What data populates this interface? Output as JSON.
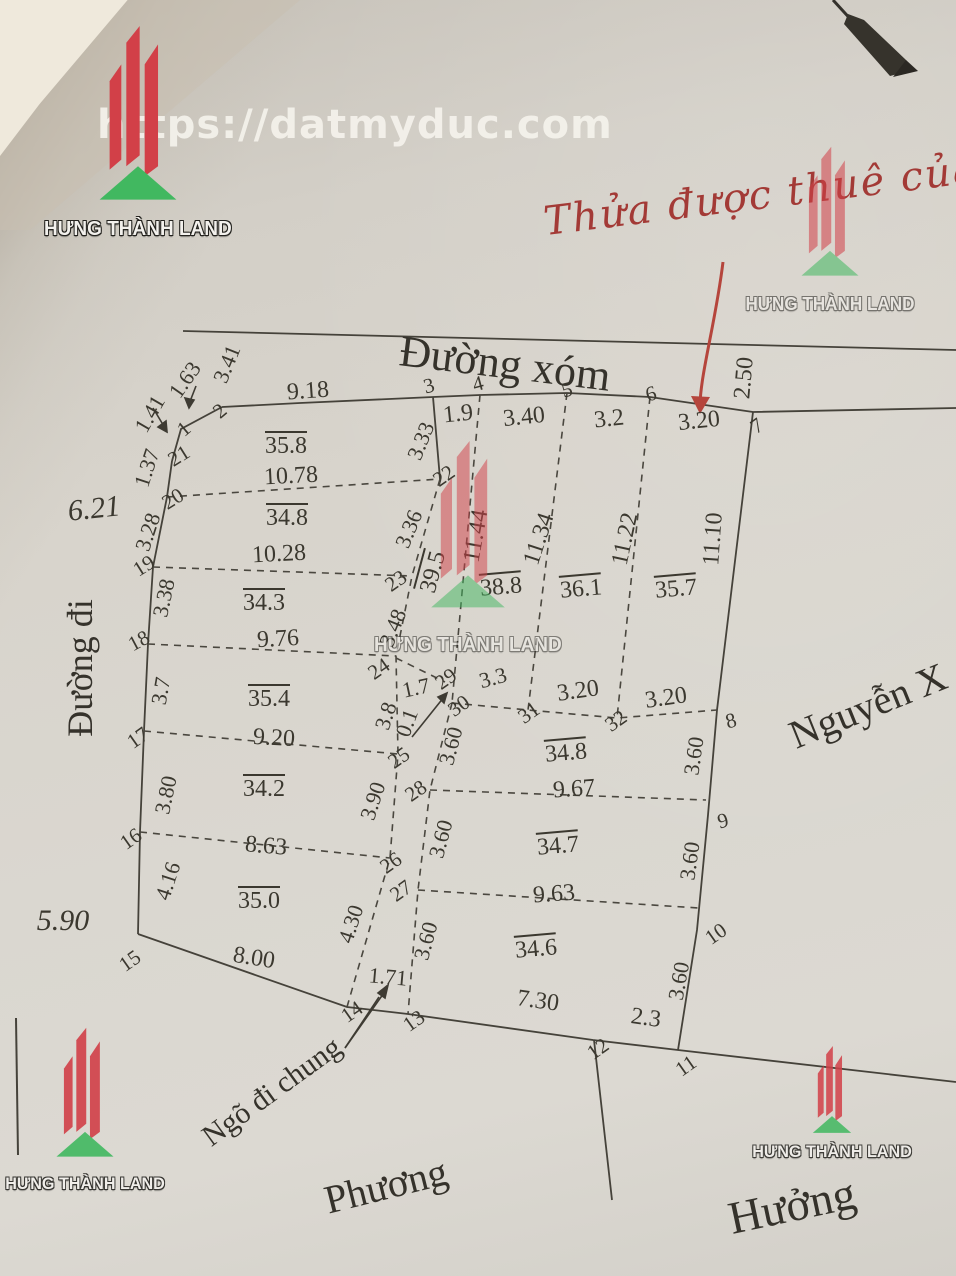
{
  "watermark": {
    "url_text": "https://datmyduc.com",
    "brand": "HƯNG THÀNH LAND",
    "brand_red": "#d24048",
    "brand_green": "#41b860"
  },
  "annotation": {
    "handwriting": "Thửa được thuê của đ",
    "color": "#a33a36"
  },
  "streets": {
    "top_road": "Đường xóm",
    "left_road": "Đường đi",
    "right_owner": "Nguyễn X",
    "bottom_left_owner": "Phương",
    "bottom_right_owner": "Hưởng",
    "alley": "Ngõ đi chung"
  },
  "map": {
    "labels": [
      {
        "t": "Đường xóm",
        "x": 505,
        "y": 364,
        "r": 7,
        "s": 44,
        "c": "street",
        "n": "street-duong-xom"
      },
      {
        "t": "Đường đi",
        "x": 80,
        "y": 668,
        "r": -90,
        "s": 36,
        "c": "street",
        "n": "street-duong-di"
      },
      {
        "t": "Nguyễn X",
        "x": 868,
        "y": 706,
        "r": -22,
        "s": 40,
        "c": "street",
        "n": "owner-nguyen-x"
      },
      {
        "t": "Phương",
        "x": 386,
        "y": 1186,
        "r": -14,
        "s": 40,
        "c": "street",
        "n": "owner-phuong"
      },
      {
        "t": "Hưởng",
        "x": 792,
        "y": 1206,
        "r": -12,
        "s": 46,
        "c": "street",
        "n": "owner-huong"
      },
      {
        "t": "Ngõ đi chung",
        "x": 272,
        "y": 1092,
        "r": -36,
        "s": 30,
        "c": "street",
        "n": "alley-label"
      },
      {
        "t": "Thửa được thuê của đ",
        "x": 782,
        "y": 193,
        "r": -7,
        "s": 40,
        "c": "note",
        "n": "handwritten-note"
      },
      {
        "t": "6.21",
        "x": 94,
        "y": 509,
        "r": -6,
        "s": 30,
        "c": "road-num"
      },
      {
        "t": "5.90",
        "x": 63,
        "y": 921,
        "r": 0,
        "s": 30,
        "c": "road-num"
      },
      {
        "t": "35.8",
        "x": 286,
        "y": 446,
        "r": 0,
        "s": 24,
        "c": "area"
      },
      {
        "t": "34.8",
        "x": 287,
        "y": 518,
        "r": 0,
        "s": 24,
        "c": "area"
      },
      {
        "t": "34.3",
        "x": 264,
        "y": 603,
        "r": 0,
        "s": 24,
        "c": "area"
      },
      {
        "t": "35.4",
        "x": 269,
        "y": 699,
        "r": 0,
        "s": 24,
        "c": "area"
      },
      {
        "t": "34.2",
        "x": 264,
        "y": 789,
        "r": 0,
        "s": 24,
        "c": "area"
      },
      {
        "t": "35.0",
        "x": 259,
        "y": 901,
        "r": 0,
        "s": 24,
        "c": "area"
      },
      {
        "t": "39.5",
        "x": 433,
        "y": 572,
        "r": -75,
        "s": 24,
        "c": "area"
      },
      {
        "t": "38.8",
        "x": 501,
        "y": 587,
        "r": -5,
        "s": 24,
        "c": "area"
      },
      {
        "t": "36.1",
        "x": 581,
        "y": 589,
        "r": -5,
        "s": 24,
        "c": "area"
      },
      {
        "t": "35.7",
        "x": 676,
        "y": 589,
        "r": -5,
        "s": 24,
        "c": "area"
      },
      {
        "t": "34.8",
        "x": 566,
        "y": 753,
        "r": -5,
        "s": 24,
        "c": "area"
      },
      {
        "t": "34.7",
        "x": 558,
        "y": 846,
        "r": -5,
        "s": 24,
        "c": "area"
      },
      {
        "t": "34.6",
        "x": 536,
        "y": 949,
        "r": -5,
        "s": 24,
        "c": "area"
      },
      {
        "t": "10.78",
        "x": 291,
        "y": 476,
        "r": -3,
        "s": 24,
        "c": "dim"
      },
      {
        "t": "10.28",
        "x": 279,
        "y": 554,
        "r": -3,
        "s": 24,
        "c": "dim"
      },
      {
        "t": "9.76",
        "x": 278,
        "y": 639,
        "r": -3,
        "s": 24,
        "c": "dim"
      },
      {
        "t": "9.20",
        "x": 274,
        "y": 738,
        "r": 3,
        "s": 24,
        "c": "dim"
      },
      {
        "t": "8.63",
        "x": 266,
        "y": 846,
        "r": 5,
        "s": 24,
        "c": "dim"
      },
      {
        "t": "8.00",
        "x": 254,
        "y": 958,
        "r": 9,
        "s": 24,
        "c": "dim"
      },
      {
        "t": "9.18",
        "x": 308,
        "y": 391,
        "r": -4,
        "s": 24,
        "c": "dim"
      },
      {
        "t": "1.9",
        "x": 458,
        "y": 414,
        "r": -6,
        "s": 24,
        "c": "dim"
      },
      {
        "t": "3.40",
        "x": 524,
        "y": 417,
        "r": -6,
        "s": 24,
        "c": "dim"
      },
      {
        "t": "3.2",
        "x": 609,
        "y": 419,
        "r": -6,
        "s": 24,
        "c": "dim"
      },
      {
        "t": "3.20",
        "x": 699,
        "y": 421,
        "r": -6,
        "s": 24,
        "c": "dim"
      },
      {
        "t": "9.67",
        "x": 574,
        "y": 789,
        "r": -4,
        "s": 24,
        "c": "dim"
      },
      {
        "t": "9.63",
        "x": 554,
        "y": 894,
        "r": -4,
        "s": 24,
        "c": "dim"
      },
      {
        "t": "7.30",
        "x": 538,
        "y": 1001,
        "r": 8,
        "s": 24,
        "c": "dim"
      },
      {
        "t": "2.3",
        "x": 646,
        "y": 1018,
        "r": 8,
        "s": 24,
        "c": "dim"
      },
      {
        "t": "1.71",
        "x": 388,
        "y": 977,
        "r": 5,
        "s": 22,
        "c": "dim"
      },
      {
        "t": "1.7",
        "x": 416,
        "y": 688,
        "r": -12,
        "s": 22,
        "c": "dim"
      },
      {
        "t": "3.3",
        "x": 493,
        "y": 678,
        "r": -15,
        "s": 22,
        "c": "dim"
      },
      {
        "t": "3.20",
        "x": 578,
        "y": 691,
        "r": -8,
        "s": 24,
        "c": "dim"
      },
      {
        "t": "3.20",
        "x": 666,
        "y": 698,
        "r": -8,
        "s": 24,
        "c": "dim"
      },
      {
        "t": "1.63",
        "x": 185,
        "y": 380,
        "r": -55,
        "s": 22,
        "c": "seg"
      },
      {
        "t": "3.41",
        "x": 227,
        "y": 364,
        "r": -68,
        "s": 22,
        "c": "seg"
      },
      {
        "t": "1.41",
        "x": 150,
        "y": 414,
        "r": -60,
        "s": 22,
        "c": "seg"
      },
      {
        "t": "1.37",
        "x": 147,
        "y": 468,
        "r": -72,
        "s": 22,
        "c": "seg"
      },
      {
        "t": "3.28",
        "x": 148,
        "y": 532,
        "r": -72,
        "s": 22,
        "c": "seg"
      },
      {
        "t": "3.38",
        "x": 164,
        "y": 598,
        "r": -78,
        "s": 22,
        "c": "seg"
      },
      {
        "t": "3.7",
        "x": 161,
        "y": 691,
        "r": -80,
        "s": 22,
        "c": "seg"
      },
      {
        "t": "3.80",
        "x": 166,
        "y": 795,
        "r": -78,
        "s": 22,
        "c": "seg"
      },
      {
        "t": "4.16",
        "x": 168,
        "y": 881,
        "r": -72,
        "s": 22,
        "c": "seg"
      },
      {
        "t": "3.33",
        "x": 421,
        "y": 441,
        "r": -68,
        "s": 22,
        "c": "seg"
      },
      {
        "t": "3.36",
        "x": 409,
        "y": 529,
        "r": -68,
        "s": 22,
        "c": "seg"
      },
      {
        "t": "3.48",
        "x": 393,
        "y": 628,
        "r": -68,
        "s": 22,
        "c": "seg"
      },
      {
        "t": "3.8",
        "x": 386,
        "y": 716,
        "r": -72,
        "s": 22,
        "c": "seg"
      },
      {
        "t": "0.1",
        "x": 407,
        "y": 723,
        "r": -70,
        "s": 22,
        "c": "seg"
      },
      {
        "t": "3.90",
        "x": 373,
        "y": 801,
        "r": -72,
        "s": 22,
        "c": "seg"
      },
      {
        "t": "4.30",
        "x": 351,
        "y": 924,
        "r": -72,
        "s": 22,
        "c": "seg"
      },
      {
        "t": "3.60",
        "x": 451,
        "y": 746,
        "r": -75,
        "s": 22,
        "c": "seg"
      },
      {
        "t": "3.60",
        "x": 441,
        "y": 839,
        "r": -75,
        "s": 22,
        "c": "seg"
      },
      {
        "t": "3.60",
        "x": 426,
        "y": 941,
        "r": -75,
        "s": 22,
        "c": "seg"
      },
      {
        "t": "3.60",
        "x": 694,
        "y": 756,
        "r": -82,
        "s": 22,
        "c": "seg"
      },
      {
        "t": "3.60",
        "x": 690,
        "y": 861,
        "r": -82,
        "s": 22,
        "c": "seg"
      },
      {
        "t": "3.60",
        "x": 679,
        "y": 981,
        "r": -80,
        "s": 22,
        "c": "seg"
      },
      {
        "t": "2.50",
        "x": 744,
        "y": 378,
        "r": -85,
        "s": 24,
        "c": "seg"
      },
      {
        "t": "11.44",
        "x": 476,
        "y": 536,
        "r": -80,
        "s": 24,
        "c": "seg"
      },
      {
        "t": "11.34",
        "x": 539,
        "y": 539,
        "r": -72,
        "s": 24,
        "c": "seg"
      },
      {
        "t": "11.22",
        "x": 625,
        "y": 539,
        "r": -78,
        "s": 24,
        "c": "seg"
      },
      {
        "t": "11.10",
        "x": 713,
        "y": 539,
        "r": -86,
        "s": 24,
        "c": "seg"
      },
      {
        "t": "1",
        "x": 184,
        "y": 429,
        "r": -40,
        "s": 21,
        "c": "vtx"
      },
      {
        "t": "2",
        "x": 220,
        "y": 411,
        "r": -40,
        "s": 21,
        "c": "vtx"
      },
      {
        "t": "3",
        "x": 429,
        "y": 386,
        "r": -15,
        "s": 21,
        "c": "vtx"
      },
      {
        "t": "4",
        "x": 478,
        "y": 384,
        "r": -15,
        "s": 21,
        "c": "vtx"
      },
      {
        "t": "5",
        "x": 567,
        "y": 390,
        "r": -15,
        "s": 21,
        "c": "vtx"
      },
      {
        "t": "6",
        "x": 651,
        "y": 394,
        "r": -15,
        "s": 21,
        "c": "vtx"
      },
      {
        "t": "7",
        "x": 757,
        "y": 426,
        "r": -35,
        "s": 21,
        "c": "vtx"
      },
      {
        "t": "8",
        "x": 731,
        "y": 721,
        "r": -15,
        "s": 21,
        "c": "vtx"
      },
      {
        "t": "9",
        "x": 723,
        "y": 821,
        "r": -15,
        "s": 21,
        "c": "vtx"
      },
      {
        "t": "10",
        "x": 716,
        "y": 934,
        "r": -35,
        "s": 21,
        "c": "vtx"
      },
      {
        "t": "11",
        "x": 686,
        "y": 1066,
        "r": -35,
        "s": 21,
        "c": "vtx"
      },
      {
        "t": "12",
        "x": 598,
        "y": 1049,
        "r": -35,
        "s": 21,
        "c": "vtx"
      },
      {
        "t": "13",
        "x": 414,
        "y": 1021,
        "r": -35,
        "s": 21,
        "c": "vtx"
      },
      {
        "t": "14",
        "x": 352,
        "y": 1012,
        "r": -35,
        "s": 21,
        "c": "vtx"
      },
      {
        "t": "15",
        "x": 130,
        "y": 961,
        "r": -35,
        "s": 21,
        "c": "vtx"
      },
      {
        "t": "16",
        "x": 131,
        "y": 839,
        "r": -35,
        "s": 21,
        "c": "vtx"
      },
      {
        "t": "17",
        "x": 138,
        "y": 738,
        "r": -35,
        "s": 21,
        "c": "vtx"
      },
      {
        "t": "18",
        "x": 139,
        "y": 641,
        "r": -28,
        "s": 21,
        "c": "vtx"
      },
      {
        "t": "19",
        "x": 144,
        "y": 566,
        "r": -32,
        "s": 21,
        "c": "vtx"
      },
      {
        "t": "20",
        "x": 173,
        "y": 499,
        "r": -32,
        "s": 21,
        "c": "vtx"
      },
      {
        "t": "21",
        "x": 179,
        "y": 456,
        "r": -32,
        "s": 21,
        "c": "vtx"
      },
      {
        "t": "22",
        "x": 444,
        "y": 476,
        "r": -35,
        "s": 21,
        "c": "vtx"
      },
      {
        "t": "23",
        "x": 396,
        "y": 581,
        "r": -35,
        "s": 21,
        "c": "vtx"
      },
      {
        "t": "24",
        "x": 379,
        "y": 669,
        "r": -35,
        "s": 21,
        "c": "vtx"
      },
      {
        "t": "25",
        "x": 399,
        "y": 758,
        "r": -35,
        "s": 21,
        "c": "vtx"
      },
      {
        "t": "26",
        "x": 391,
        "y": 863,
        "r": -35,
        "s": 21,
        "c": "vtx"
      },
      {
        "t": "27",
        "x": 401,
        "y": 891,
        "r": -35,
        "s": 21,
        "c": "vtx"
      },
      {
        "t": "28",
        "x": 416,
        "y": 791,
        "r": -35,
        "s": 21,
        "c": "vtx"
      },
      {
        "t": "29",
        "x": 446,
        "y": 679,
        "r": -35,
        "s": 21,
        "c": "vtx"
      },
      {
        "t": "30",
        "x": 459,
        "y": 706,
        "r": -35,
        "s": 21,
        "c": "vtx"
      },
      {
        "t": "31",
        "x": 529,
        "y": 713,
        "r": -35,
        "s": 21,
        "c": "vtx"
      },
      {
        "t": "32",
        "x": 616,
        "y": 721,
        "r": -35,
        "s": 21,
        "c": "vtx"
      }
    ]
  }
}
